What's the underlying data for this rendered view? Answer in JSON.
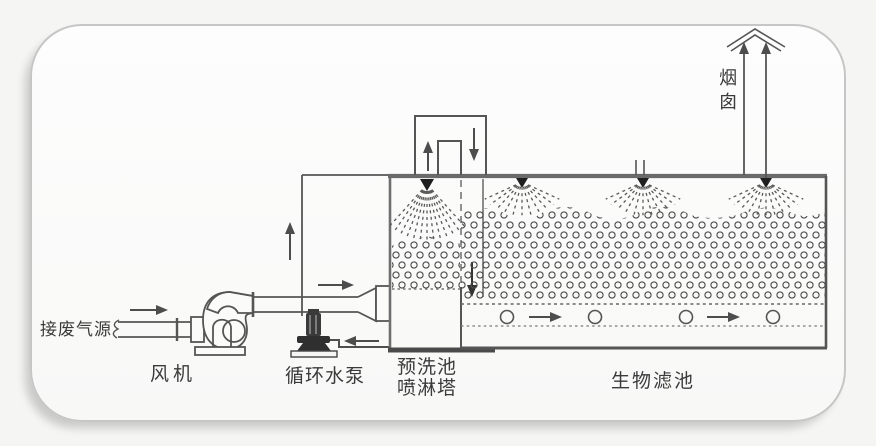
{
  "labels": {
    "source": "接废气源",
    "fan": "风机",
    "pump": "循环水泵",
    "prewash": "预洗池\n喷淋塔",
    "biofilter": "生物滤池",
    "chimney": "烟囱"
  },
  "components": [
    "waste-gas-inlet-pipe",
    "centrifugal-fan",
    "circulating-pump",
    "prewash-pool-spray-tower",
    "crossover-duct",
    "biofilter-bed",
    "packing-media",
    "spray-nozzles",
    "air-plenum",
    "chimney-stack"
  ],
  "colors": {
    "line": "#555555",
    "thick_line": "#6a6a6a",
    "dark_fill": "#2f2f2f",
    "text": "#3b3b3b",
    "card_border": "#c6c6c6",
    "card_bg": "#fcfcfb",
    "page_bg": "#f5f5f3"
  }
}
